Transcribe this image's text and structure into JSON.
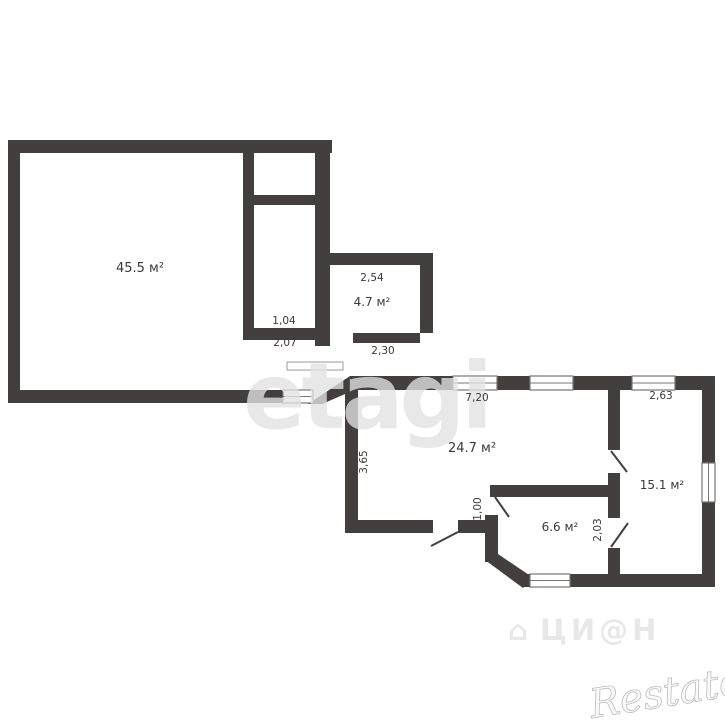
{
  "plan": {
    "background": "#ffffff",
    "wall_color": "#433f3f",
    "label_color": "#3a3a3a",
    "window_line_color": "#7a7676",
    "rooms": [
      {
        "name": "room-45-5",
        "label": "45.5 м²",
        "x": 140,
        "y": 272,
        "size": 13
      },
      {
        "name": "room-4-7",
        "label": "4.7 м²",
        "x": 372,
        "y": 306,
        "size": 12
      },
      {
        "name": "room-24-7",
        "label": "24.7 м²",
        "x": 472,
        "y": 452,
        "size": 13
      },
      {
        "name": "room-6-6",
        "label": "6.6 м²",
        "x": 560,
        "y": 531,
        "size": 12
      },
      {
        "name": "room-15-1",
        "label": "15.1 м²",
        "x": 662,
        "y": 489,
        "size": 12
      }
    ],
    "dimensions": [
      {
        "name": "dim-2-54",
        "label": "2,54",
        "x": 372,
        "y": 281,
        "rot": 0
      },
      {
        "name": "dim-2-30",
        "label": "2,30",
        "x": 383,
        "y": 354,
        "rot": 0
      },
      {
        "name": "dim-1-04",
        "label": "1,04",
        "x": 284,
        "y": 324,
        "rot": 0
      },
      {
        "name": "dim-2-07",
        "label": "2,07",
        "x": 285,
        "y": 346,
        "rot": 0
      },
      {
        "name": "dim-7-20",
        "label": "7,20",
        "x": 477,
        "y": 401,
        "rot": 0
      },
      {
        "name": "dim-2-63",
        "label": "2,63",
        "x": 661,
        "y": 399,
        "rot": 0
      },
      {
        "name": "dim-3-65",
        "label": "3,65",
        "x": 367,
        "y": 462,
        "rot": -90
      },
      {
        "name": "dim-1-00",
        "label": "1,00",
        "x": 481,
        "y": 509,
        "rot": -90
      },
      {
        "name": "dim-2-03",
        "label": "2,03",
        "x": 601,
        "y": 530,
        "rot": -90
      }
    ],
    "walls": [
      {
        "name": "big-room-wall-top",
        "x": 8,
        "y": 140,
        "w": 324,
        "h": 13
      },
      {
        "name": "big-room-wall-left",
        "x": 8,
        "y": 140,
        "w": 12,
        "h": 263
      },
      {
        "name": "big-room-wall-bottom",
        "x": 8,
        "y": 390,
        "w": 277,
        "h": 13
      },
      {
        "name": "big-room-wall-right",
        "x": 315,
        "y": 140,
        "w": 15,
        "h": 206
      },
      {
        "name": "closet-wall-left",
        "x": 243,
        "y": 140,
        "w": 11,
        "h": 200
      },
      {
        "name": "closet-divider",
        "x": 243,
        "y": 195,
        "w": 77,
        "h": 10
      },
      {
        "name": "closet-wall-bottom",
        "x": 243,
        "y": 328,
        "w": 72,
        "h": 12
      },
      {
        "name": "room47-wall-top",
        "x": 318,
        "y": 253,
        "w": 115,
        "h": 12
      },
      {
        "name": "room47-wall-right",
        "x": 420,
        "y": 253,
        "w": 13,
        "h": 80
      },
      {
        "name": "room47-wall-bottom",
        "x": 353,
        "y": 333,
        "w": 67,
        "h": 10
      },
      {
        "name": "section-wall-top",
        "x": 350,
        "y": 376,
        "w": 365,
        "h": 14
      },
      {
        "name": "section-wall-right",
        "x": 702,
        "y": 376,
        "w": 13,
        "h": 211
      },
      {
        "name": "section-wall-bottom",
        "x": 523,
        "y": 574,
        "w": 192,
        "h": 13
      },
      {
        "name": "room247-wall-left",
        "x": 345,
        "y": 388,
        "w": 13,
        "h": 145
      },
      {
        "name": "room247-wall-bottom-left",
        "x": 345,
        "y": 520,
        "w": 88,
        "h": 13
      },
      {
        "name": "room247-wall-bottom-right",
        "x": 458,
        "y": 520,
        "w": 34,
        "h": 13
      },
      {
        "name": "room66-wall-left",
        "x": 485,
        "y": 515,
        "w": 13,
        "h": 47
      },
      {
        "name": "room66-wall-top",
        "x": 490,
        "y": 485,
        "w": 127,
        "h": 12
      },
      {
        "name": "interior-wall-upper",
        "x": 608,
        "y": 388,
        "w": 12,
        "h": 62
      },
      {
        "name": "interior-wall-middle",
        "x": 608,
        "y": 473,
        "w": 12,
        "h": 45
      },
      {
        "name": "interior-wall-lower",
        "x": 608,
        "y": 548,
        "w": 12,
        "h": 27
      }
    ],
    "diagonal_walls": [
      {
        "name": "hall-diagonal-wall",
        "points": "308,404 350,376 352,391 322,404"
      },
      {
        "name": "bay-chamfer-wall",
        "points": "485,560 498,554 532,577 523,588"
      }
    ],
    "windows": [
      {
        "name": "window-hall",
        "x": 283,
        "y": 390,
        "w": 30,
        "h": 13,
        "dir": "h"
      },
      {
        "name": "window-247-left",
        "x": 453,
        "y": 376,
        "w": 44,
        "h": 14,
        "dir": "h"
      },
      {
        "name": "window-247-right",
        "x": 530,
        "y": 376,
        "w": 43,
        "h": 14,
        "dir": "h"
      },
      {
        "name": "window-151-top",
        "x": 632,
        "y": 376,
        "w": 43,
        "h": 14,
        "dir": "h"
      },
      {
        "name": "window-151-right",
        "x": 702,
        "y": 463,
        "w": 13,
        "h": 39,
        "dir": "v"
      },
      {
        "name": "window-66-bottom",
        "x": 530,
        "y": 574,
        "w": 40,
        "h": 13,
        "dir": "h"
      }
    ],
    "doors": [
      {
        "name": "door-247",
        "x1": 458,
        "y1": 532,
        "x2": 431,
        "y2": 546
      },
      {
        "name": "door-66",
        "x1": 495,
        "y1": 497,
        "x2": 509,
        "y2": 517
      },
      {
        "name": "door-151-upper",
        "x1": 611,
        "y1": 451,
        "x2": 627,
        "y2": 472
      },
      {
        "name": "door-151-lower",
        "x1": 611,
        "y1": 547,
        "x2": 628,
        "y2": 523
      }
    ],
    "openings": [
      {
        "name": "hall-threshold",
        "x": 287,
        "y": 362,
        "w": 56,
        "h": 8
      }
    ]
  },
  "watermarks": {
    "center_logo": "etagi",
    "center_color": "rgba(226,226,226,0.78)",
    "portal_icon": "⌂",
    "portal_logo": "ЦИ@Н",
    "portal_color": "rgba(214,214,214,0.55)",
    "corner_logo": "Restate",
    "corner_fill": "#fafafa",
    "corner_stroke": "#bdbdbd"
  }
}
